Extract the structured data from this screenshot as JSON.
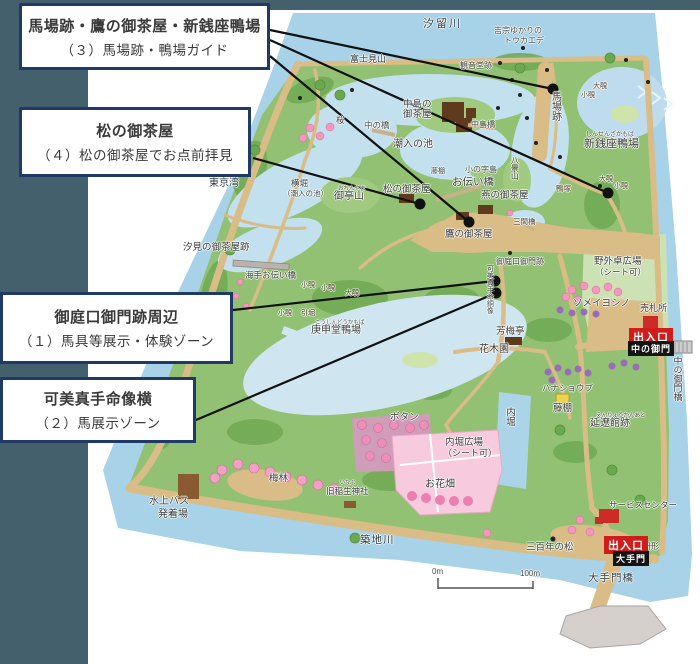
{
  "callouts": [
    {
      "title": "馬場跡・鷹の御茶屋・新銭座鴨場",
      "subtitle": "（３）馬場跡・鴨場ガイド"
    },
    {
      "title": "松の御茶屋",
      "subtitle": "（４）松の御茶屋でお点前拝見"
    },
    {
      "title": "御庭口御門跡周辺",
      "subtitle": "（１）馬具等展示・体験ゾーン"
    },
    {
      "title": "可美真手命像横",
      "subtitle": "（２）馬展示ゾーン"
    }
  ],
  "map": {
    "labels": {
      "shiodome_river": "汐留川",
      "yoshimune_1": "吉宗ゆかりの",
      "yoshimune_2": "トウカエデ",
      "baba_ato": "馬場跡",
      "shinsenza_furigana": "しんせんざかもば",
      "shinsenza_kamoba": "新銭座鴨場",
      "oonozoki_n": "大覗",
      "konozoki_n": "小覗",
      "kamotsuka": "鴨塚",
      "oonozoki_e": "大覗",
      "konozoki_e": "小覗",
      "fujimiyama": "富士見山",
      "kannondo_ato": "観音堂跡",
      "nakajima_no": "中島の",
      "ochaya": "御茶屋",
      "nakajima_bashi": "中島橋",
      "naka_no_hashi": "中の橋",
      "sakura": "桜",
      "shioiri_no_ike": "潮入の池",
      "yokobori": "横堀",
      "yokobori_sub": "（潮入の池）",
      "ochinyama_furigana": "おちんやま",
      "ochinyama": "御亭山",
      "matsu_no_ochaya": "松の御茶屋",
      "fujidana_n": "藤棚",
      "konoji_jima": "小の字島",
      "otsutai_bashi": "お伝い橋",
      "hakkei_zan": "八景山",
      "tsubame_no_ochaya": "燕の御茶屋",
      "sangen_bashi": "三間橋",
      "taka_no_ochaya": "鷹の御茶屋",
      "tokyo_wan": "東京湾",
      "shiomi_no_ochaya_ato": "汐見の御茶屋跡",
      "umite_otsutai_bashi": "海手お伝い橋",
      "konozoki_w1": "小覗",
      "konozoki_w2": "小覗",
      "oonozoki_w": "大覗",
      "konozoki_w3": "小覗",
      "hikibori": "引堀",
      "koshindo_furigana": "こうしんどうかもば",
      "koshindo_kamoba": "庚申堂鴨場",
      "oniwaguchi_gomon_ato": "御庭口御門跡",
      "kamimate_statue": "可美真手命銅像",
      "yagai_hiroba": "野外卓広場",
      "yagai_hiroba_sub": "（シート可）",
      "somei_yoshino": "ソメイヨシノ",
      "satsujo": "売札所",
      "nakanogomon_bashi": "中の御門橋",
      "hobai_tei": "芳梅亭",
      "kaboku_en": "花木園",
      "hanashobu": "ハナショウブ",
      "fujidana_s": "藤棚",
      "enryokan_furigana": "えんりょうかんあと",
      "enryokan_ato": "延遼館跡",
      "uchibori": "内堀",
      "uchibori_hiroba": "内堀広場",
      "uchibori_hiroba_sub": "（シート可）",
      "botan": "ボタン",
      "ohanabatake": "お花畑",
      "bairin": "梅林",
      "kyu_inabu_furigana": "いなぶ",
      "kyu_inabu_jinja": "旧稲生神社",
      "suijo_bus_1": "水上バス",
      "suijo_bus_2": "発着場",
      "tsukiji_gawa": "築地川",
      "sanbyakunen_no_matsu": "三百年の松",
      "service_center": "サービスセンター",
      "masugata": "枡形",
      "otemon_bashi": "大手門橋"
    },
    "badges": {
      "naka_exit": "出入口",
      "naka_gate": "中の御門",
      "ote_exit": "出入口",
      "ote_gate": "大手門"
    },
    "scale": {
      "start": "0m",
      "end": "100m"
    },
    "colors": {
      "slate_background": "#44606c",
      "callout_border": "#1f3a66",
      "water": "#a7d2e8",
      "pond": "#c2e0ee",
      "land": "#92c173",
      "path_tan": "#d9bc86",
      "entrance_red": "#d11c1c",
      "gate_black": "#141414",
      "flower_pink": "#f397bc",
      "flower_purple": "#9a6cb8",
      "building_brown": "#5f3a1d"
    }
  }
}
